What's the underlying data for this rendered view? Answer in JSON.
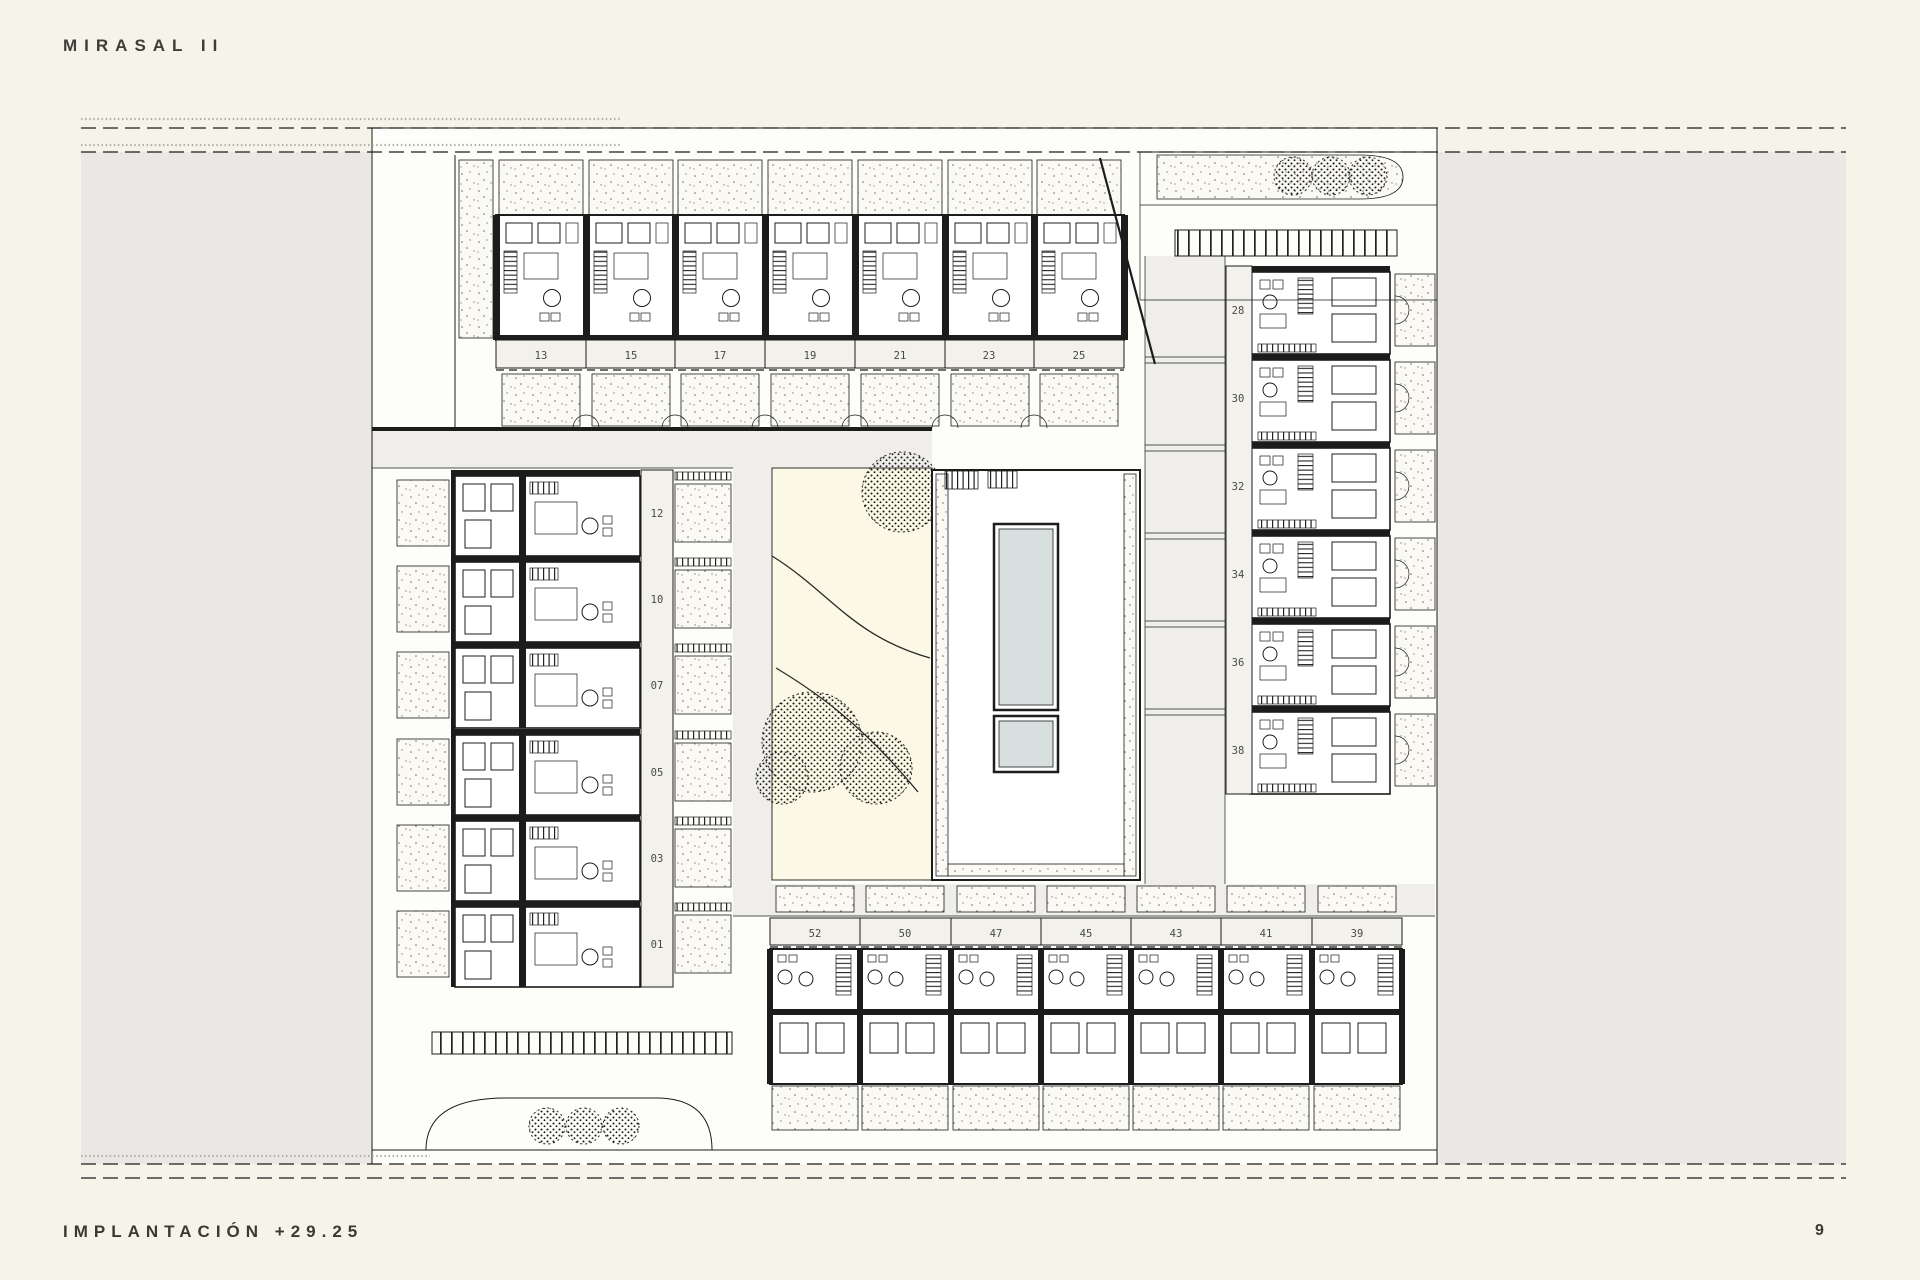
{
  "header": {
    "project_title": "MIRASAL II"
  },
  "footer": {
    "caption": "IMPLANTACIÓN +29.25",
    "page_number": "9"
  },
  "site_plan": {
    "top_row_units": [
      "13",
      "15",
      "17",
      "19",
      "21",
      "23",
      "25"
    ],
    "left_column_units": [
      "12",
      "10",
      "07",
      "05",
      "03",
      "01"
    ],
    "right_column_units": [
      "28",
      "30",
      "32",
      "34",
      "36",
      "38"
    ],
    "bottom_row_units": [
      "52",
      "50",
      "47",
      "45",
      "43",
      "41",
      "39"
    ],
    "colors": {
      "paper": "#f6f3e9",
      "field_grey": "#e9e8e4",
      "drawing_line": "#1c1c1c",
      "pool_water": "#d8e0df",
      "garden_fill": "#fbf8e6"
    }
  }
}
